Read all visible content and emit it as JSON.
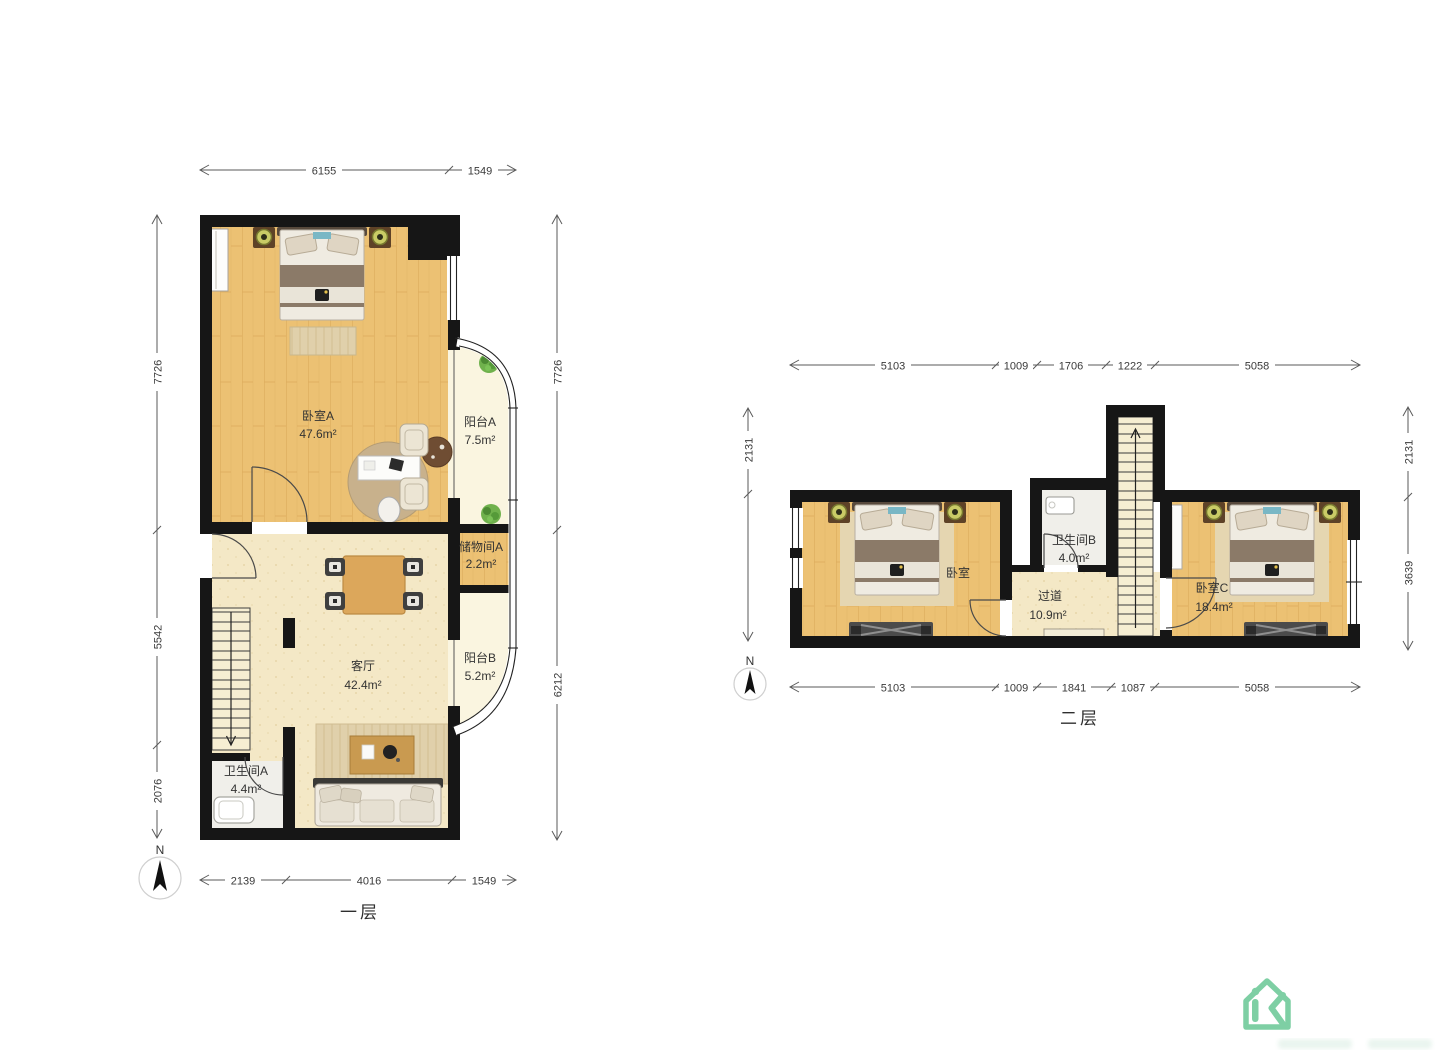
{
  "floor1": {
    "label": "一层",
    "compass_label": "N",
    "rooms": [
      {
        "name": "卧室A",
        "area": "47.6m²"
      },
      {
        "name": "阳台A",
        "area": "7.5m²"
      },
      {
        "name": "储物间A",
        "area": "2.2m²"
      },
      {
        "name": "客厅",
        "area": "42.4m²"
      },
      {
        "name": "阳台B",
        "area": "5.2m²"
      },
      {
        "name": "卫生间A",
        "area": "4.4m²"
      }
    ],
    "dims": {
      "top": [
        "6155",
        "1549"
      ],
      "bottom": [
        "2139",
        "4016",
        "1549"
      ],
      "left": [
        "7726",
        "5542",
        "2076"
      ],
      "right": [
        "7726",
        "6212"
      ]
    }
  },
  "floor2": {
    "label": "二层",
    "compass_label": "N",
    "rooms": [
      {
        "name": "卧室",
        "area": ""
      },
      {
        "name": "卫生间B",
        "area": "4.0m²"
      },
      {
        "name": "过道",
        "area": "10.9m²"
      },
      {
        "name": "卧室C",
        "area": "18.4m²"
      }
    ],
    "dims": {
      "top": [
        "5103",
        "1009",
        "1706",
        "1222",
        "5058"
      ],
      "bottom": [
        "5103",
        "1009",
        "1841",
        "1087",
        "5058"
      ],
      "left": [
        "2131"
      ],
      "right": [
        "2131",
        "3639"
      ]
    }
  },
  "logo": {
    "icon": "house-ik-logo"
  },
  "colors": {
    "wall": "#161616",
    "wood_floor": "#ECC173",
    "living_floor": "#F4E8C6",
    "balcony_floor": "#FAF5E0",
    "bath_floor": "#F0EFEA",
    "logo_green": "#7ECFA4"
  }
}
